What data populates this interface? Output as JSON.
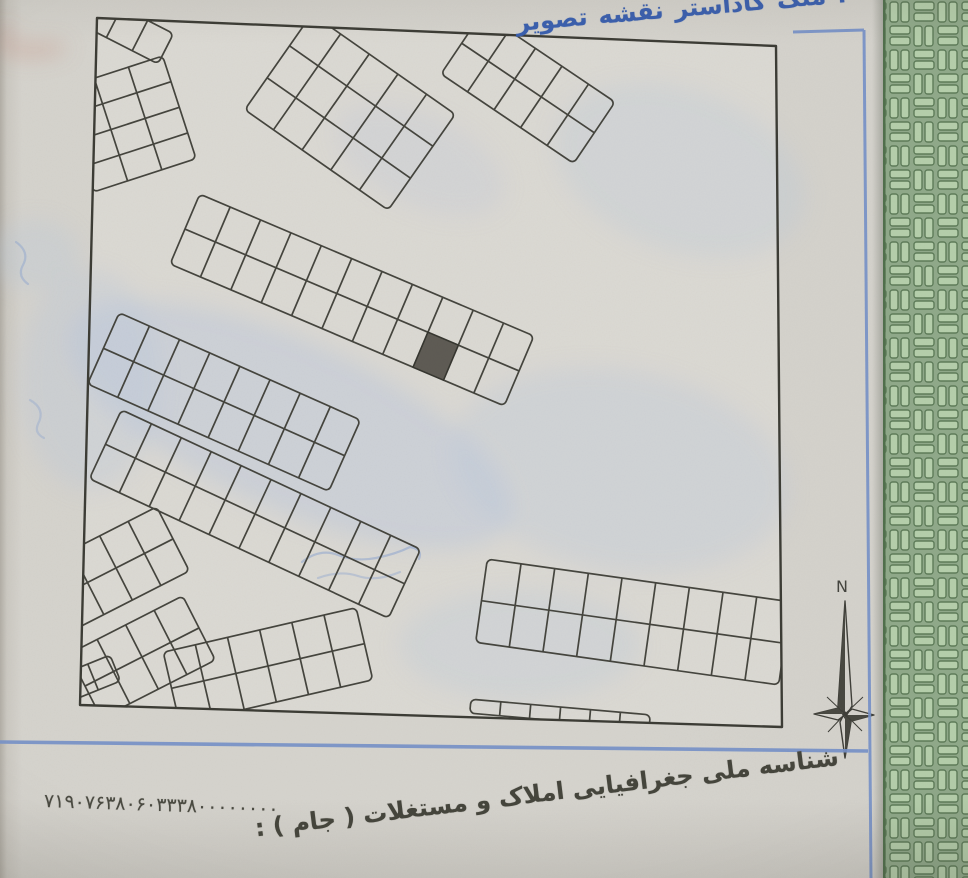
{
  "captions": {
    "top": {
      "text": "تصویر نقشه کاداستر ملک :",
      "display": "ltr-words"
    },
    "bottom": {
      "text": "شناسه ملی جغرافیایی املاک و مستغلات ( جام ) :",
      "display": "rtl"
    }
  },
  "jam_number": "۷۱۹۰۷۶۳۸۰۶۰۳۳۳۸۰۰۰۰۰۰۰۰",
  "compass": {
    "north_label": "N"
  },
  "colors": {
    "title_ink": "#3a5fae",
    "caption_ink": "#45453c",
    "map_line": "#43433c",
    "highlighted_plot_fill": "#56544c",
    "paper": "#d6d4ce",
    "blue_border": "#7490c8",
    "security_green_bg": "#8fa989",
    "security_green_brick": "#b5cfab",
    "security_green_line": "#5d7b58"
  },
  "map": {
    "frame": [
      [
        97,
        18
      ],
      [
        776,
        46
      ],
      [
        782,
        727
      ],
      [
        80,
        705
      ]
    ],
    "blocks": [
      {
        "name": "block-corner-tl",
        "cx": 127,
        "cy": 29,
        "angle": 27,
        "rows": 1,
        "cols": 3,
        "cw": 29,
        "ch": 34
      },
      {
        "name": "block-left-fan",
        "cx": 128,
        "cy": 124,
        "angle": -18,
        "rows": 4,
        "cols": 3,
        "cw": 36,
        "ch": 27
      },
      {
        "name": "block-top-a",
        "cx": 350,
        "cy": 112,
        "angle": 35,
        "rows": 3,
        "cols": 5,
        "cw": 35,
        "ch": 39
      },
      {
        "name": "block-top-b",
        "cx": 528,
        "cy": 88,
        "angle": 34,
        "rows": 2,
        "cols": 5,
        "cw": 32,
        "ch": 37
      },
      {
        "name": "block-mid-main",
        "cx": 352,
        "cy": 300,
        "angle": 23,
        "rows": 2,
        "cols": 11,
        "cw": 33,
        "ch": 38,
        "dark": [
          1,
          8
        ]
      },
      {
        "name": "block-mid-left",
        "cx": 224,
        "cy": 402,
        "angle": 24,
        "rows": 2,
        "cols": 8,
        "cw": 33,
        "ch": 39
      },
      {
        "name": "block-low-mid",
        "cx": 255,
        "cy": 514,
        "angle": 25,
        "rows": 2,
        "cols": 10,
        "cw": 33,
        "ch": 38
      },
      {
        "name": "block-left-low-a",
        "cx": 116,
        "cy": 568,
        "angle": -27,
        "rows": 2,
        "cols": 4,
        "cw": 32,
        "ch": 36
      },
      {
        "name": "block-left-low-b",
        "cx": 142,
        "cy": 657,
        "angle": -27,
        "rows": 2,
        "cols": 4,
        "cw": 32,
        "ch": 36
      },
      {
        "name": "block-bottom-mid",
        "cx": 268,
        "cy": 666,
        "angle": -13,
        "rows": 2,
        "cols": 6,
        "cw": 33,
        "ch": 37
      },
      {
        "name": "block-bottom-right",
        "cx": 633,
        "cy": 622,
        "angle": 8,
        "rows": 2,
        "cols": 9,
        "cw": 34,
        "ch": 42
      },
      {
        "name": "block-bottom-sliver",
        "cx": 560,
        "cy": 714,
        "angle": 5,
        "rows": 1,
        "cols": 6,
        "cw": 30,
        "ch": 14
      },
      {
        "name": "block-corner-bl",
        "cx": 93,
        "cy": 677,
        "angle": -22,
        "rows": 1,
        "cols": 2,
        "cw": 24,
        "ch": 28
      }
    ]
  }
}
